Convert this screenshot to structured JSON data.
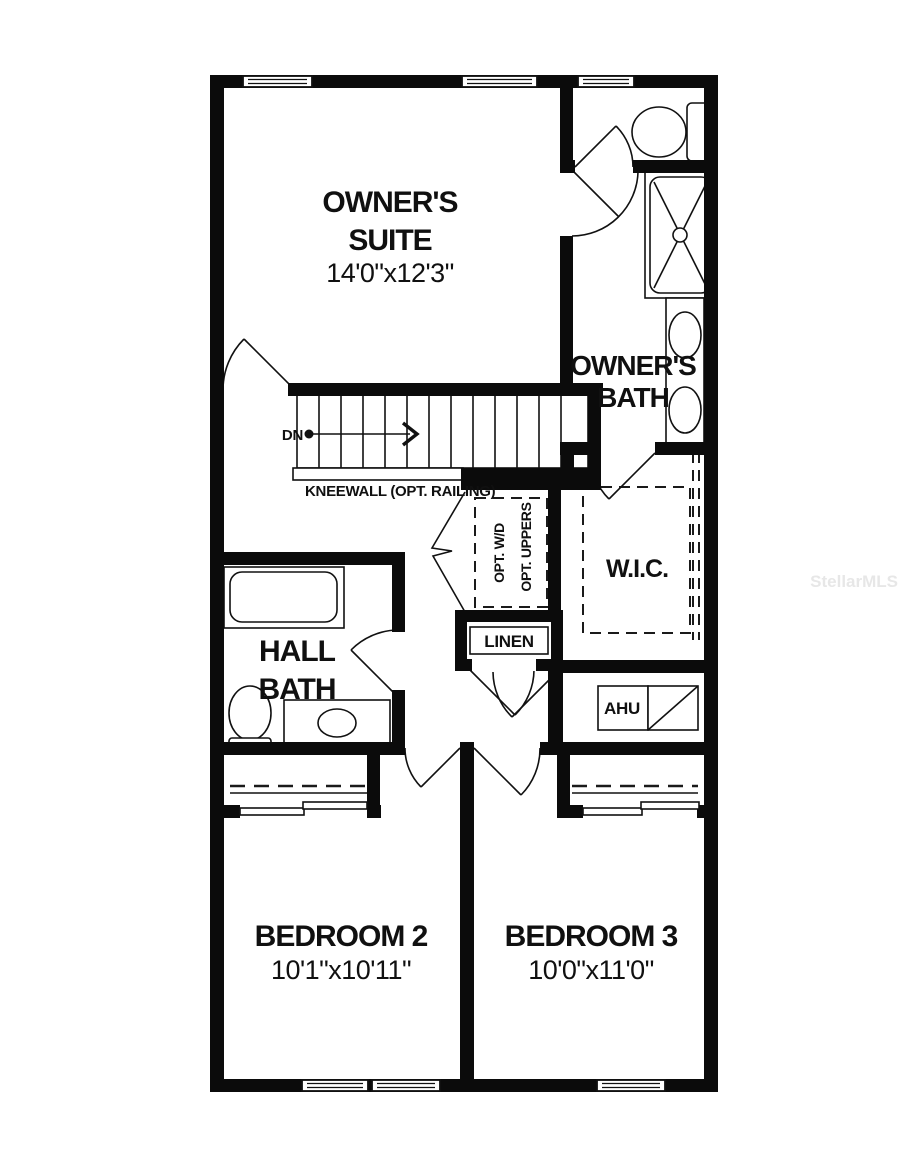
{
  "plan": {
    "watermark": "StellarMLS",
    "colors": {
      "wall": "#0b0b0b",
      "line": "#111111",
      "background": "#ffffff",
      "watermark": "#e7e7e7"
    },
    "rooms": {
      "owners_suite": {
        "label_line1": "OWNER'S",
        "label_line2": "SUITE",
        "dims": "14'0\"x12'3\""
      },
      "owners_bath": {
        "label_line1": "OWNER'S",
        "label_line2": "BATH"
      },
      "wic": {
        "label": "W.I.C."
      },
      "hall_bath": {
        "label_line1": "HALL",
        "label_line2": "BATH"
      },
      "bedroom2": {
        "label": "BEDROOM 2",
        "dims": "10'1\"x10'11\""
      },
      "bedroom3": {
        "label": "BEDROOM 3",
        "dims": "10'0\"x11'0\""
      }
    },
    "annotations": {
      "dn": "DN",
      "kneewall": "KNEEWALL (OPT. RAILING)",
      "opt_wd": "OPT. W/D",
      "opt_uppers": "OPT. UPPERS",
      "linen": "LINEN",
      "ahu": "AHU"
    }
  }
}
